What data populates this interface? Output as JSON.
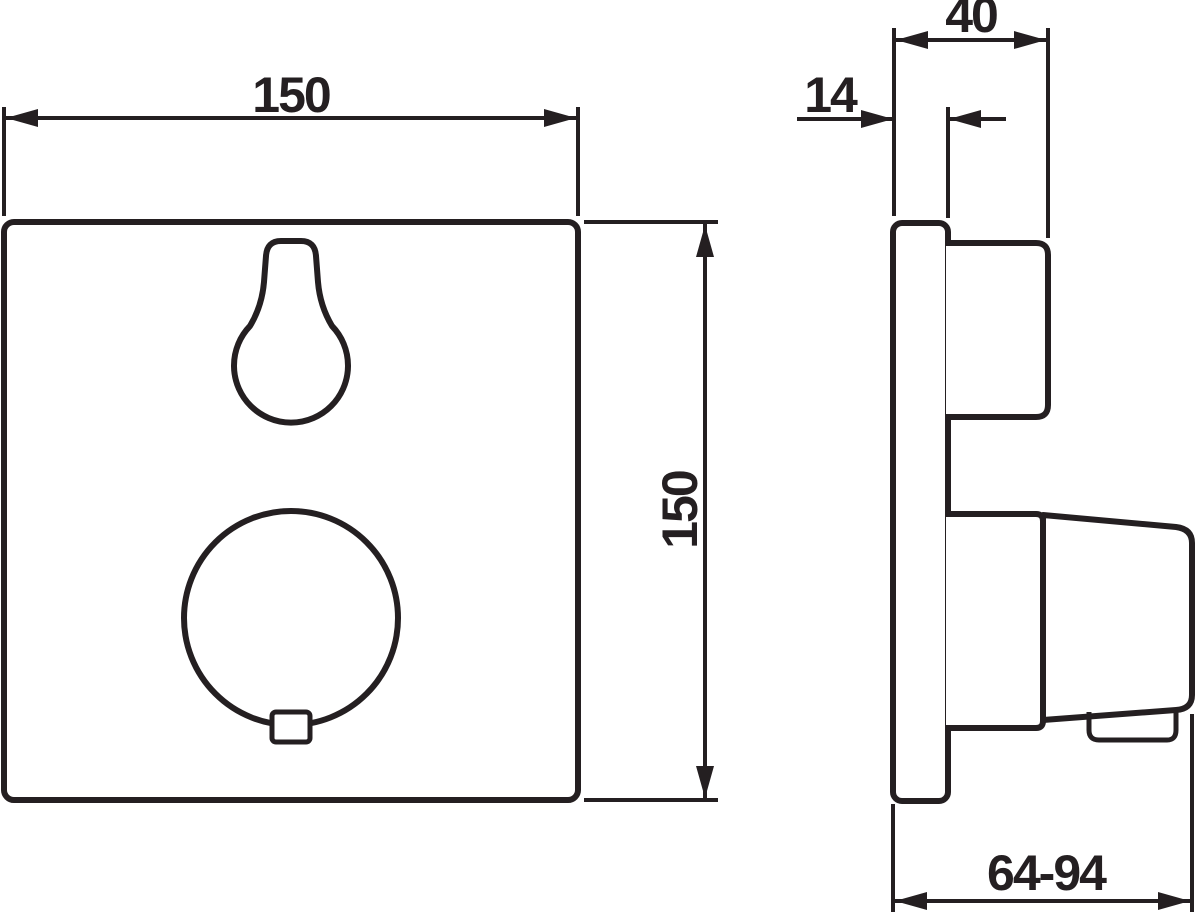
{
  "palette": {
    "line_color": "#241f21",
    "background_color": "#ffffff"
  },
  "dimensions": {
    "front_width": "150",
    "front_height": "150",
    "depth": "40",
    "plate_thickness": "14",
    "wall_to_knob_range": "64-94"
  }
}
